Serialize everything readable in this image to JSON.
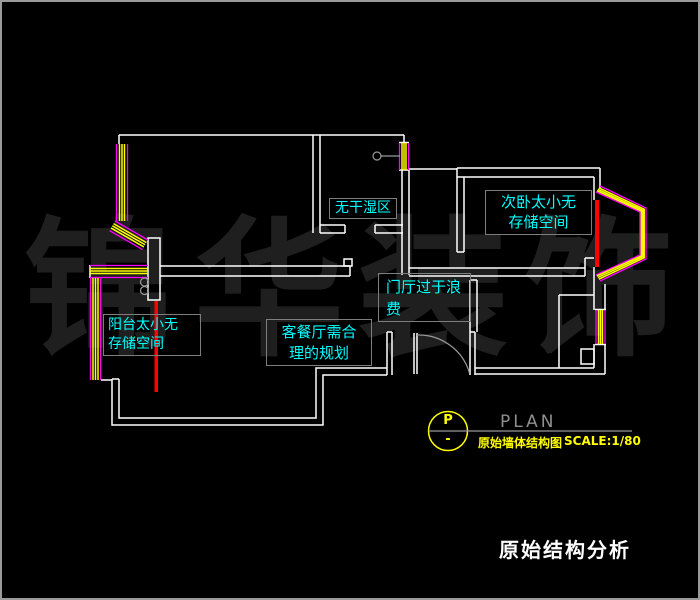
{
  "frame": {
    "background": "#000000",
    "border_color": "#9a9a9a"
  },
  "watermark": {
    "color": "#1f1f1f",
    "chars": [
      "锦",
      "华",
      "装",
      "饰"
    ]
  },
  "labels": {
    "bathroom": {
      "lines": [
        "无干湿区"
      ]
    },
    "bedroom2": {
      "lines": [
        "次卧太小无",
        "存储空间"
      ]
    },
    "hall": {
      "lines": [
        "门厅过于浪",
        "费"
      ]
    },
    "balcony": {
      "lines": [
        "阳台太小无",
        "存储空间"
      ]
    },
    "living": {
      "lines": [
        "客餐厅需合",
        "理的规划"
      ]
    }
  },
  "legend": {
    "marker_letter": "P",
    "marker_dash": "-",
    "plan_word": "PLAN",
    "drawing_name": "原始墙体结构图",
    "scale": "SCALE:1/80"
  },
  "title": {
    "text": "原始结构分析"
  },
  "colors": {
    "wall": "#ffffff",
    "window_glass": "#ffff00",
    "window_frame": "#ff00ff",
    "demolition_mark": "#ff0000",
    "annotation_text": "#00ffff",
    "annotation_border": "#7d7d7d",
    "legend_yellow": "#ffff00",
    "plan_gray": "#8f8f8f",
    "watermark_gray": "#1f1f1f"
  }
}
